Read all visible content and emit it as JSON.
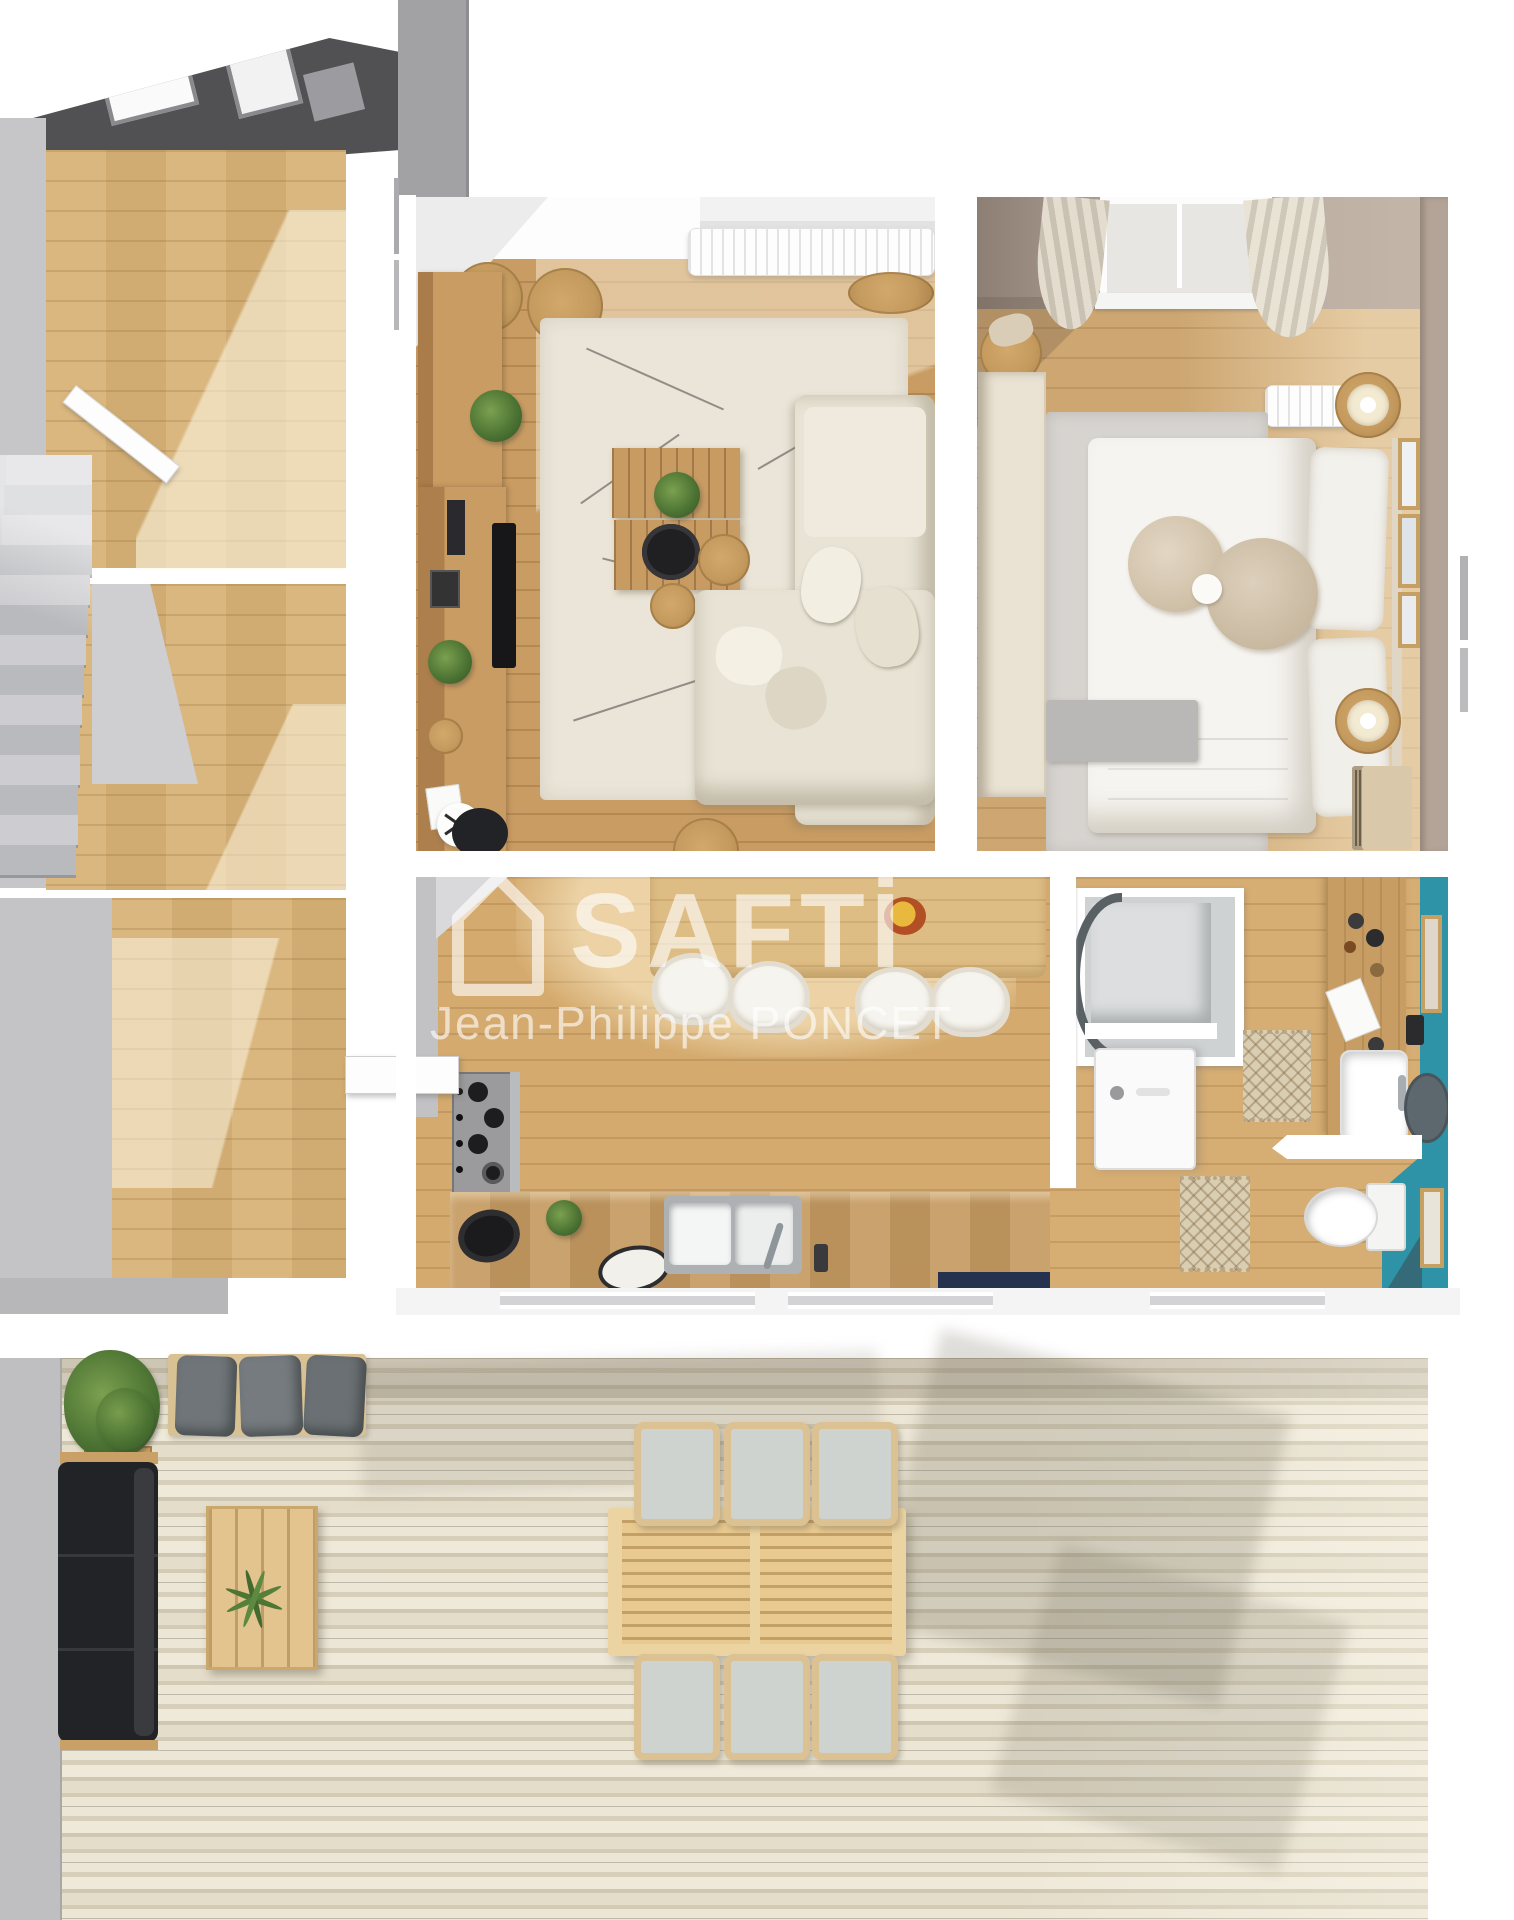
{
  "watermark": {
    "brand": "SAFTİ",
    "agent": "Jean-Philippe PONCET",
    "logo_icon": "house-outline-icon",
    "text_color": "rgba(255,255,255,0.62)"
  },
  "colors": {
    "background": "#ffffff",
    "watermark": "rgba(255,255,255,0.62)",
    "wall_gray": "#c6c6c9",
    "wall_dark": "#515154",
    "wall_taupe": "#b3a497",
    "wall_teal": "#2e93a6",
    "floor_oak": "#d8b377",
    "floor_living": "#c99c63",
    "floor_kitchen": "#d4aa6e",
    "rug_cream": "#eae5d8",
    "rug_gray": "#d7d4d0",
    "sofa_cream": "#e8e3d5",
    "cushion_gray": "#6f7578",
    "sofa_black": "#222326",
    "wood_furniture": "#c89b63",
    "jute": "#c49a5e",
    "stairs_gray": "#c6c6ca",
    "navy_mat": "#24324f"
  }
}
